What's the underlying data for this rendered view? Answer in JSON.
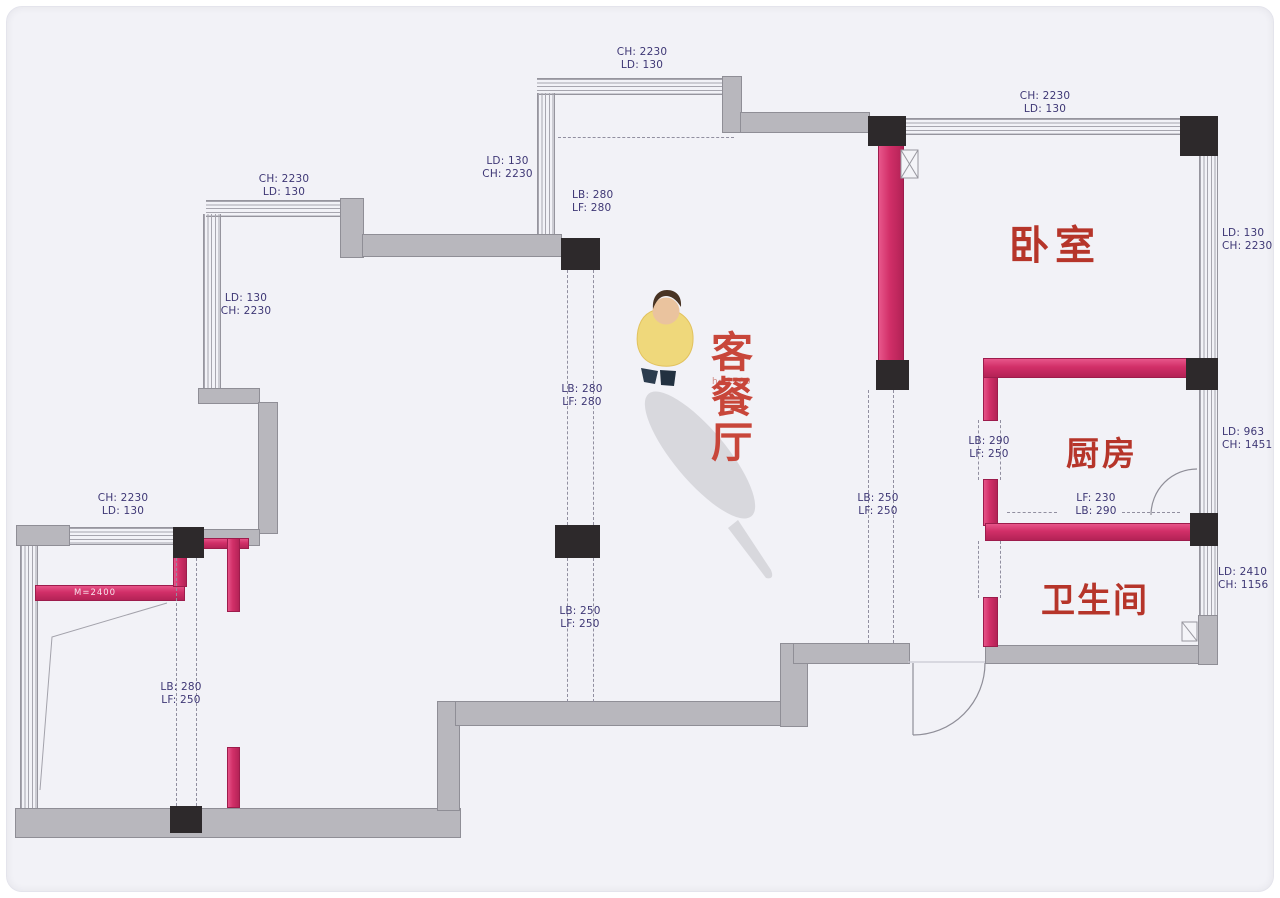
{
  "plan": {
    "type": "apartment-floor-plan",
    "rooms": {
      "bedroom": "卧室",
      "kitchen": "厨房",
      "bathroom": "卫生间",
      "living_dining": [
        "客",
        "餐",
        "厅"
      ],
      "living_height_note": "h=2700"
    },
    "wall_note": "M=2400",
    "colors": {
      "accent_pink": "#d12f68",
      "wall_gray": "#b8b7bd",
      "pillar_black": "#2d292b",
      "dim_text": "#3e3775",
      "room_text": "#b6352a",
      "background": "#f2f2f7"
    },
    "dim_labels": [
      {
        "name": "top-left-window",
        "l1": "CH: 2230",
        "l2": "LD: 130"
      },
      {
        "name": "top-mid-window",
        "l1": "CH: 2230",
        "l2": "LD: 130"
      },
      {
        "name": "top-right-window",
        "l1": "CH: 2230",
        "l2": "LD: 130"
      },
      {
        "name": "left-upper",
        "l1": "LD: 130",
        "l2": "CH: 2230"
      },
      {
        "name": "mid-upper",
        "l1": "LD: 130",
        "l2": "CH: 2230"
      },
      {
        "name": "beam-upper",
        "l1": "LB: 280",
        "l2": "LF: 280"
      },
      {
        "name": "beam-mid",
        "l1": "LB: 280",
        "l2": "LF: 280"
      },
      {
        "name": "beam-lower",
        "l1": "LB: 250",
        "l2": "LF: 250"
      },
      {
        "name": "beam-entry",
        "l1": "LB: 250",
        "l2": "LF: 250"
      },
      {
        "name": "kitchen-door",
        "l1": "LB: 290",
        "l2": "LF: 250"
      },
      {
        "name": "kitchen-bottom",
        "l1": "LF: 230",
        "l2": "LB: 290"
      },
      {
        "name": "bedroom-right",
        "l1": "LD: 130",
        "l2": "CH: 2230"
      },
      {
        "name": "kitchen-right",
        "l1": "LD: 963",
        "l2": "CH: 1451"
      },
      {
        "name": "bathroom-right",
        "l1": "LD: 2410",
        "l2": "CH: 1156"
      },
      {
        "name": "left-lower-window",
        "l1": "CH: 2230",
        "l2": "LD: 130"
      },
      {
        "name": "left-beam",
        "l1": "LB: 280",
        "l2": "LF: 250"
      }
    ]
  }
}
